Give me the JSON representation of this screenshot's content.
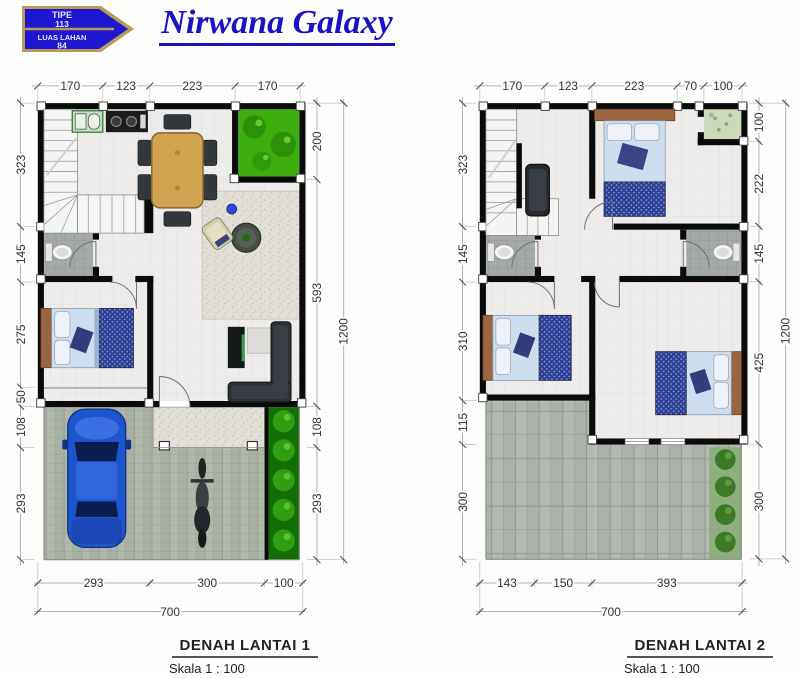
{
  "header": {
    "badge": {
      "tipe_label": "TIPE",
      "tipe_value": "113",
      "luas_label": "LUAS LAHAN",
      "luas_value": "84"
    },
    "title": "Nirwana Galaxy"
  },
  "plan1": {
    "title": "DENAH LANTAI 1",
    "scale": "Skala 1 : 100",
    "dims": {
      "top": [
        "170",
        "123",
        "223",
        "170"
      ],
      "left": [
        "323",
        "145",
        "275",
        "50",
        "108",
        "293"
      ],
      "right": [
        "200",
        "593",
        "108",
        "293"
      ],
      "right_total": "1200",
      "bottom": [
        "293",
        "300",
        "100"
      ],
      "bottom_total": "700"
    }
  },
  "plan2": {
    "title": "DENAH LANTAI 2",
    "scale": "Skala 1 : 100",
    "dims": {
      "top": [
        "170",
        "123",
        "223",
        "70",
        "100"
      ],
      "left": [
        "323",
        "145",
        "310",
        "115",
        "300"
      ],
      "right": [
        "100",
        "222",
        "145",
        "425",
        "300"
      ],
      "right_total": "1200",
      "bottom": [
        "143",
        "150",
        "393"
      ],
      "bottom_total": "700"
    }
  },
  "colors": {
    "brand_blue": "#1d18cf",
    "brand_gold": "#b99a58",
    "wall_black": "#0b0b0b",
    "garden_green": "#3dae0e",
    "paving_gray": "#b0b8ab",
    "bed_sheet_blue": "#cfdeee",
    "blanket_blue": "#2c3d94",
    "car_blue": "#1c55cc"
  }
}
